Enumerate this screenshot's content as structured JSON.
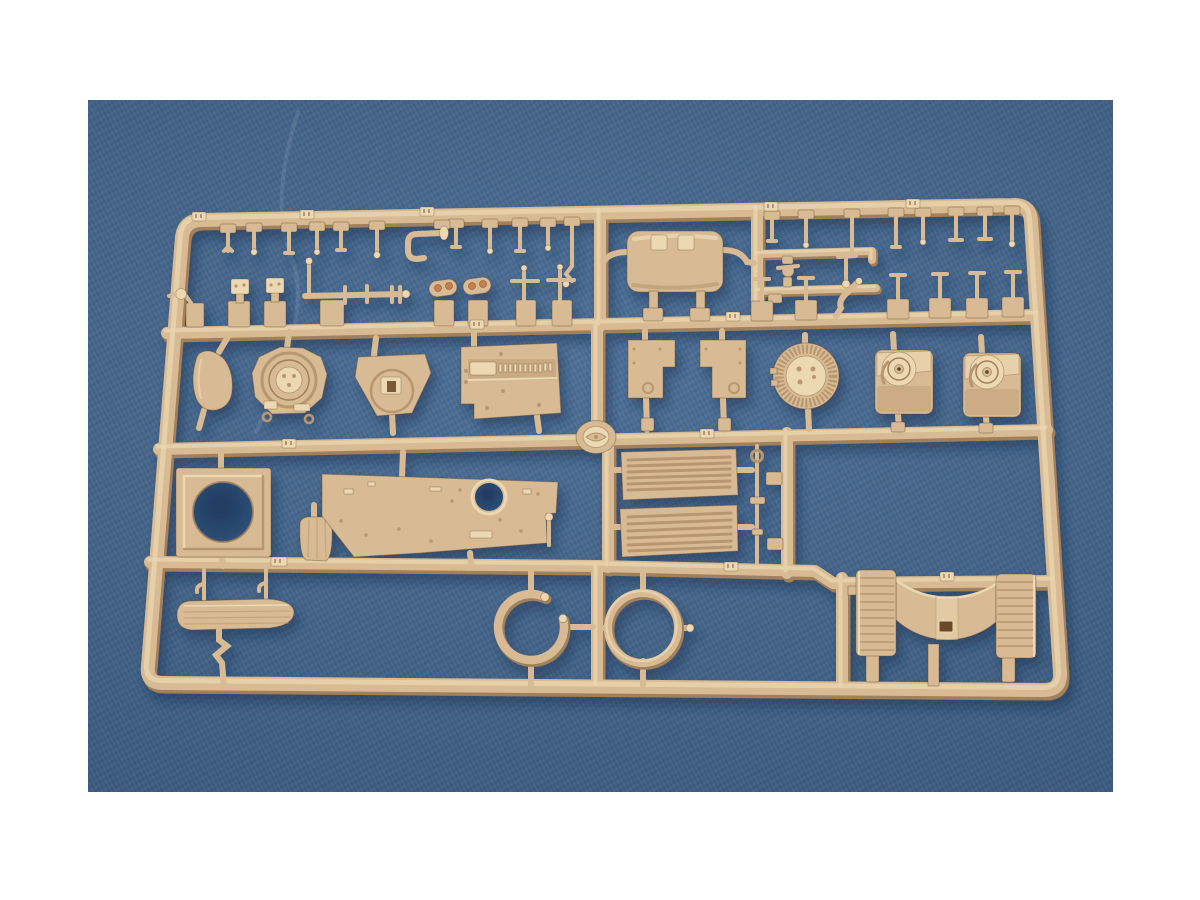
{
  "page": {
    "title": "Tan model-kit sprue on blue fabric",
    "aria_label": "Product photograph of a tan plastic injection-molded model kit sprue (parts runner) lying on a blue fabric backdrop, framed by white borders"
  },
  "photo": {
    "subject": "Injection-molded styrene parts sprue from a scale armor model kit",
    "plastic_color_name": "dark-yellow tan styrene",
    "backdrop": "blue cloth",
    "parts": {
      "frame": {
        "label": "Outer rectangular runner frame"
      },
      "rails": {
        "label": "Internal cross rails and vertical runners"
      },
      "pins_tl": {
        "label": "Row of small pins and brackets, top left"
      },
      "j_pipe": {
        "label": "J-shaped pipe with end flange"
      },
      "muffler": {
        "label": "Exhaust muffler box with mounting straps and elbows"
      },
      "pins_tr": {
        "label": "Row of small pins and brackets, top right"
      },
      "linkages": {
        "label": "Small linkage sub-parts on thin sub-rails"
      },
      "bent_rod": {
        "label": "Bent Z-shaped rod"
      },
      "lamp": {
        "label": "Lamp bracket part"
      },
      "knobs": {
        "label": "Two knob-topped bracket parts"
      },
      "torsion_bar": {
        "label": "Long torsion-bar axle with flanges and fork end"
      },
      "periscopes": {
        "label": "Two periscope heads with amber lenses"
      },
      "pintles": {
        "label": "Two cross-shaped pintle mounts"
      },
      "side_plate": {
        "label": "Small curved oval plate"
      },
      "turret_ring": {
        "label": "Octagonal plate with turret ring detail"
      },
      "gun_shield": {
        "label": "Gun shield plate with round boss and slot"
      },
      "vent_panel": {
        "label": "Large rectangular panel with toothed vent channel"
      },
      "fenders": {
        "label": "Two flat stepped plates"
      },
      "fan_cover": {
        "label": "Large round ribbed fan cover"
      },
      "final_drives": {
        "label": "Two final-drive housings with circular bosses"
      },
      "medallion": {
        "label": "Round maker medallion molded on center rail"
      },
      "hatch_plate": {
        "label": "Square plate with large circular opening"
      },
      "pouch": {
        "label": "Small rounded stowage pouch"
      },
      "deck_plate": {
        "label": "Wide deck plate with round opening and fittings"
      },
      "grilles": {
        "label": "Two louvered engine grilles"
      },
      "rod": {
        "label": "Thin cleaning rod with ring end"
      },
      "rod_blocks": {
        "label": "Two small blocks beside the rod"
      },
      "ring_open": {
        "label": "Open C-shaped ring"
      },
      "ring_closed": {
        "label": "Closed tow ring"
      },
      "board": {
        "label": "Elongated stowage board with grooves"
      },
      "hooks": {
        "label": "Two hook-shaped hangers"
      },
      "z_bracket": {
        "label": "Zig-zag bracket strip"
      },
      "cradle": {
        "label": "Gun cradle saddle with two ribbed drums"
      },
      "tabs": {
        "label": "Raised part-number tabs on rails"
      },
      "crease": {
        "label": "Faint crease line in the fabric"
      }
    }
  },
  "colors": {
    "page_bg": "#ffffff",
    "photo_bg": "#40658f",
    "photo_bg_deep": "#32517c",
    "photo_bg_light": "#4a70a0",
    "hole_dark": "#27456e",
    "plastic_base": "#d8bb94",
    "plastic_light": "#ecd9b4",
    "plastic_dark": "#b8976f",
    "plastic_deep": "#a1805a",
    "plastic_edge": "rgba(100,70,40,0.40)",
    "accent_amber": "#c97f4e",
    "shadow": "#12294a"
  }
}
